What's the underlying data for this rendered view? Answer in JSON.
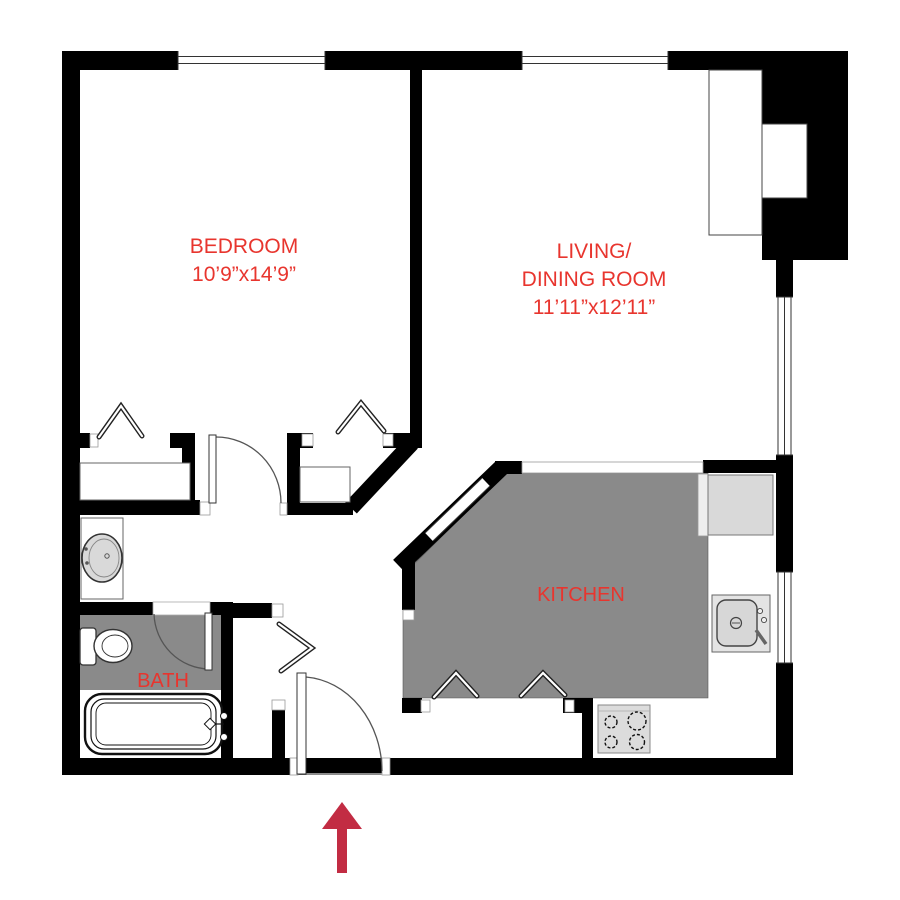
{
  "rooms": {
    "bedroom": {
      "label": "BEDROOM",
      "dims": "10’9”x14’9”"
    },
    "living": {
      "line1": "LIVING/",
      "line2": "DINING ROOM",
      "dims": "11’11”x12’11”"
    },
    "kitchen": {
      "label": "KITCHEN"
    },
    "bath": {
      "label": "BATH"
    }
  },
  "fixtures": {
    "vanity_sink": "vanity-sink-icon",
    "toilet": "toilet-icon",
    "bathtub": "bathtub-icon",
    "kitchen_sink": "kitchen-sink-icon",
    "stove": "stove-burners-icon",
    "entry_arrow": "entry-direction-arrow-icon",
    "bifold_chevron": "bifold-door-chevron-icon",
    "window": "window-double-line-icon"
  },
  "colors": {
    "label_red": "#e8352e",
    "arrow_red": "#c22c43",
    "floor_gray": "#8a8a8a",
    "counter_gray": "#d9d9d9",
    "wall_black": "#000000"
  }
}
